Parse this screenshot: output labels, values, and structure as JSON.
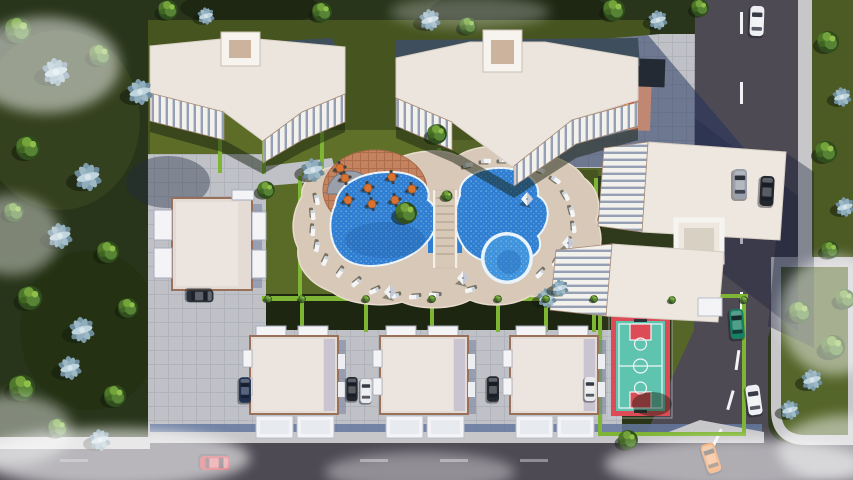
{
  "title": "Aerial 3D render of a residential complex with pool, basketball court and playground",
  "scene": {
    "description": "Top-down architectural visualization: four white apartment blocks with stepped balconies, three villas in a row, a low-rise west residence, a freeform twin-lobe swimming pool with bridge and round kids pool, cafe terrace with orange tables, sun deck with loungers and white umbrellas, teal-and-red basketball court, shaded playground with red climber and yellow slide, dark asphalt roads on the east and south with cars, olive lawns, bright hedges, green and blue-gray trees, white fog wisps.",
    "buildings": {
      "apartment_blocks": 4,
      "villas": 3,
      "west_residence": 1
    },
    "amenities": {
      "main_pool": {
        "shape": "freeform twin-lobe with bridge",
        "water_fill": "#2f7ed2"
      },
      "kids_pool": {
        "shape": "round",
        "water_fill": "#3f93dc"
      },
      "sun_deck": {
        "loungers": 24,
        "umbrellas": 4,
        "deck_fill": "#d8c8b8"
      },
      "cafe_terrace": {
        "tables": 8,
        "floor_fill": "#c5825e"
      },
      "basketball_court": {
        "floor_fill": "#5ec4b0",
        "key_fill": "#dd4b57",
        "line_color": "#f2f5f6"
      },
      "playground": {
        "mat_fill": "#c08873",
        "climber_fill": "#d63a2c",
        "slide_fill": "#efb62c",
        "canopy_fill": "#232a33"
      }
    },
    "roads": {
      "east": "two-lane asphalt with dashed centerline",
      "south": "two-lane asphalt"
    },
    "vehicles": [
      {
        "id": "car-east-road-north",
        "color_name": "white",
        "fill": "#eef0f3"
      },
      {
        "id": "car-east-road-parked-silver",
        "color_name": "silver",
        "fill": "#9aa0aa"
      },
      {
        "id": "car-east-road-parked-black",
        "color_name": "black",
        "fill": "#22262d"
      },
      {
        "id": "car-east-road-teal",
        "color_name": "teal",
        "fill": "#177f63"
      },
      {
        "id": "car-east-road-white",
        "color_name": "white",
        "fill": "#eef0f3"
      },
      {
        "id": "car-intersection-orange",
        "color_name": "orange",
        "fill": "#e8761d"
      },
      {
        "id": "car-south-road-red",
        "color_name": "red",
        "fill": "#c6202a"
      },
      {
        "id": "car-west-residence",
        "color_name": "graphite",
        "fill": "#2b3139"
      },
      {
        "id": "car-villa1-left",
        "color_name": "navy",
        "fill": "#21304f"
      },
      {
        "id": "car-villa-gap1-black",
        "color_name": "black",
        "fill": "#22262d"
      },
      {
        "id": "car-villa-gap1-white",
        "color_name": "white",
        "fill": "#e9ebee"
      },
      {
        "id": "car-villa-gap2-black",
        "color_name": "black",
        "fill": "#23272e"
      },
      {
        "id": "car-villa-gap3-white",
        "color_name": "white",
        "fill": "#e9ebee"
      }
    ]
  },
  "colors": {
    "ground": "#2e3a1b",
    "woodland": "#28351a",
    "lawn-lit": "#5f7029",
    "lawn-mid": "#46541f",
    "lawn-dark": "#1c2611",
    "hedge": "#7fb534",
    "road": "#4e4a54",
    "sidewalk": "#c7c6c9",
    "plaza": "#bfc1c6",
    "deck": "#d8c8b8",
    "pool-water": "#2f7ed2",
    "kiddie-water": "#3f93dc",
    "pool-rim": "#e9f3fb",
    "patio": "#c5825e",
    "building-roof": "#ece5dd",
    "building-lit": "#f7f3ee",
    "building-trim": "#a78a76",
    "slate-roof": "#3f4e5c",
    "villa-roof": "#e4dbd4",
    "villa-trim": "#99705a",
    "balcony-white": "#f4f4f6",
    "court-floor": "#5ec4b0",
    "court-red": "#dd4b57",
    "playground-mat": "#c08873",
    "play-red": "#d63a2c",
    "play-yellow": "#efb62c",
    "shade-dark": "#232a33",
    "wall-blue": "#64789f",
    "fog": "#ffffff"
  }
}
